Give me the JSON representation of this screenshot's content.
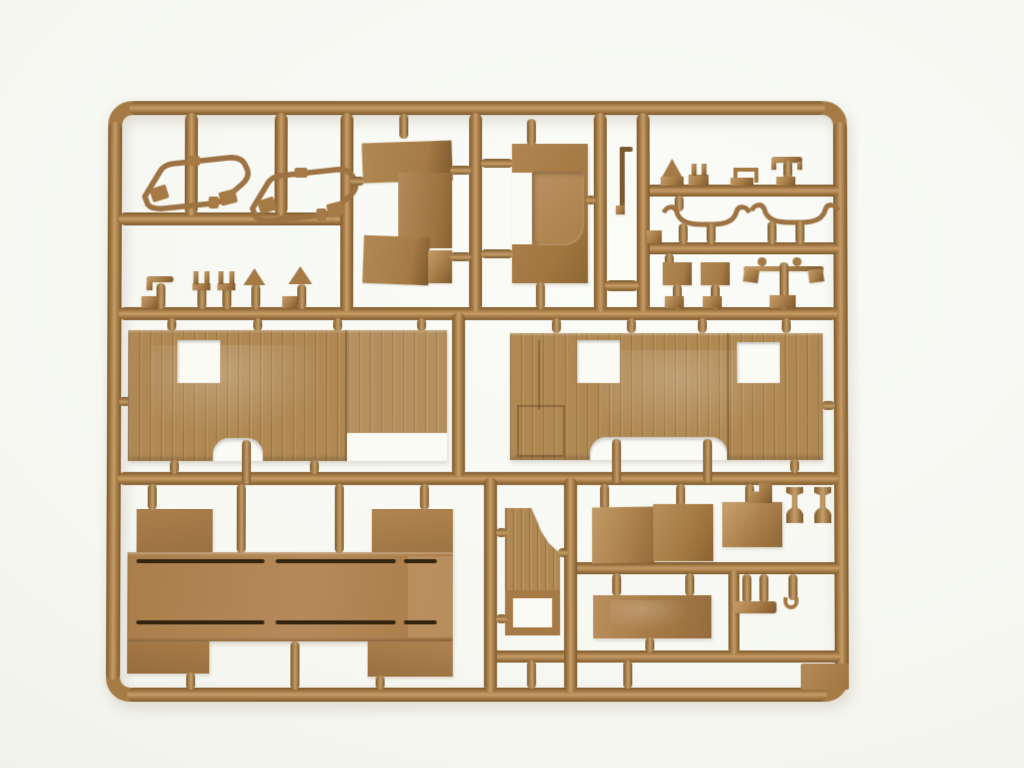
{
  "scene": {
    "description": "Close-up photograph of an injection-molded plastic model-kit sprue (parts tree) in tan/sand colored plastic lying on a seamless off-white background",
    "object": "model-kit-sprue",
    "plastic_color_name": "tan",
    "background_name": "off-white seamless paper",
    "visible_text": ""
  },
  "palette": {
    "bg_top": "#f6f7f1",
    "bg_bottom": "#edefe6",
    "bg_right": "#fbfcf8",
    "plastic": "#a57a45",
    "plastic_light": "#c59d68",
    "plastic_dark": "#7c5a2d",
    "panel": "#b08852",
    "recess": "#b58a57",
    "slot": "#32240f",
    "cutout": "#fbfbf6",
    "shadow": "rgba(100,80,50,0.18)"
  },
  "parts": [
    {
      "name": "grab-handle-loop",
      "count": 2,
      "area": "top-left"
    },
    {
      "name": "small-clamps-and-hooks-row",
      "count": 5,
      "area": "left-middle"
    },
    {
      "name": "cab-rear-panel",
      "count": 1,
      "area": "top-center-left"
    },
    {
      "name": "bench-seat",
      "count": 1,
      "area": "top-center"
    },
    {
      "name": "small-fittings-row",
      "count": 4,
      "area": "top-right-row1"
    },
    {
      "name": "bow-support",
      "count": 2,
      "area": "top-right-row2"
    },
    {
      "name": "flat-plates-and-linkage",
      "count": 3,
      "area": "top-right-row3"
    },
    {
      "name": "plank-side-panel-with-window-and-wheel-arch",
      "count": 1,
      "area": "middle-left"
    },
    {
      "name": "plank-side-panel-with-two-windows-and-wheel-arch",
      "count": 1,
      "area": "middle-right"
    },
    {
      "name": "cargo-bed-floor-with-slots-and-flaps",
      "count": 1,
      "area": "bottom-left"
    },
    {
      "name": "plank-door-with-window-frame",
      "count": 1,
      "area": "bottom-center"
    },
    {
      "name": "fender-panel",
      "count": 3,
      "area": "bottom-center-right"
    },
    {
      "name": "stowage-box-panel",
      "count": 1,
      "area": "bottom-right"
    },
    {
      "name": "pedestal-mount",
      "count": 2,
      "area": "bottom-right"
    },
    {
      "name": "rod-and-bracket-parts",
      "count": 3,
      "area": "bottom-right"
    },
    {
      "name": "blank-corner-tab",
      "count": 1,
      "area": "bottom-right-corner"
    }
  ]
}
